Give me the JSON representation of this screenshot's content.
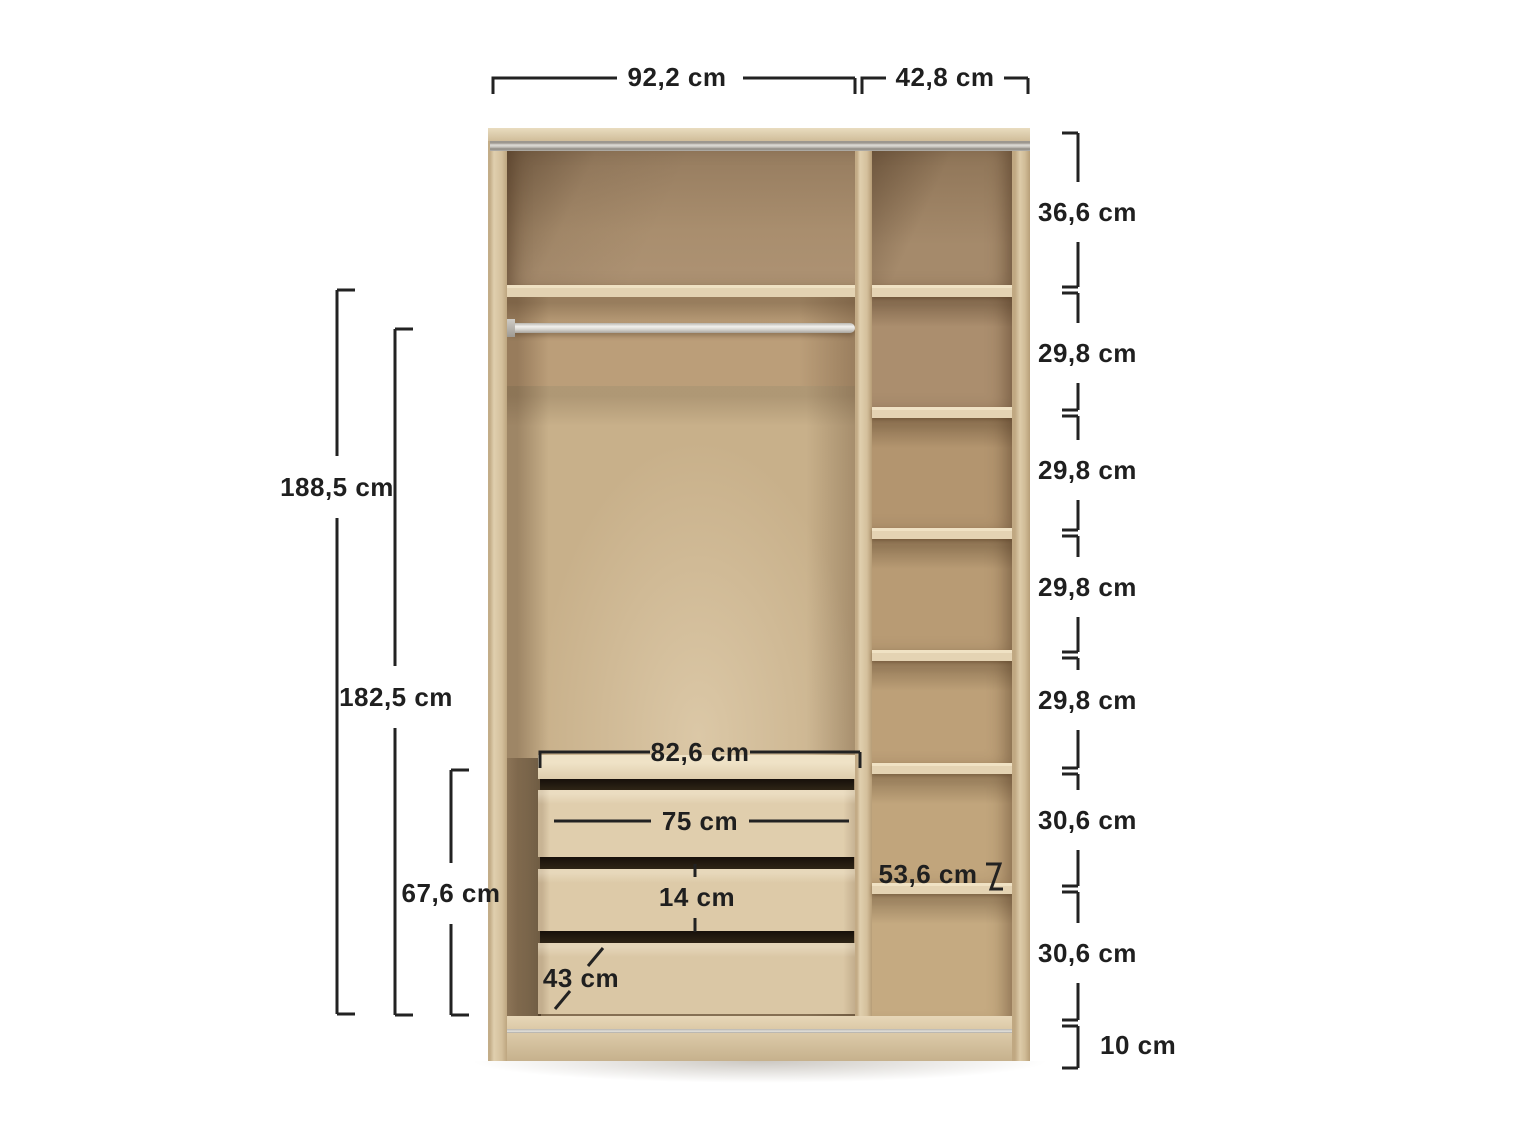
{
  "diagram": {
    "unit": "cm",
    "colors": {
      "dimension_lines": "#222222",
      "dimension_text": "#1f1f1f",
      "wood_light": "#e2d1b2",
      "wood_medium": "#c2a87f",
      "wood_dark": "#a0855f",
      "metal_rail": "#d9d7d2",
      "background": "#ffffff"
    },
    "labels": {
      "width_left_section": "92,2 cm",
      "width_right_section": "42,8 cm",
      "height_total": "188,5 cm",
      "height_interior": "182,5 cm",
      "drawer_unit_height": "67,6 cm",
      "drawer_unit_width": "82,6 cm",
      "drawer_width": "75 cm",
      "drawer_front_height": "14 cm",
      "drawer_depth": "43 cm",
      "shelf_depth": "53,6 cm",
      "plinth_height": "10 cm"
    },
    "right_sections": [
      {
        "label": "36,6 cm"
      },
      {
        "label": "29,8 cm"
      },
      {
        "label": "29,8 cm"
      },
      {
        "label": "29,8 cm"
      },
      {
        "label": "29,8 cm"
      },
      {
        "label": "30,6 cm"
      },
      {
        "label": "30,6 cm"
      }
    ]
  }
}
